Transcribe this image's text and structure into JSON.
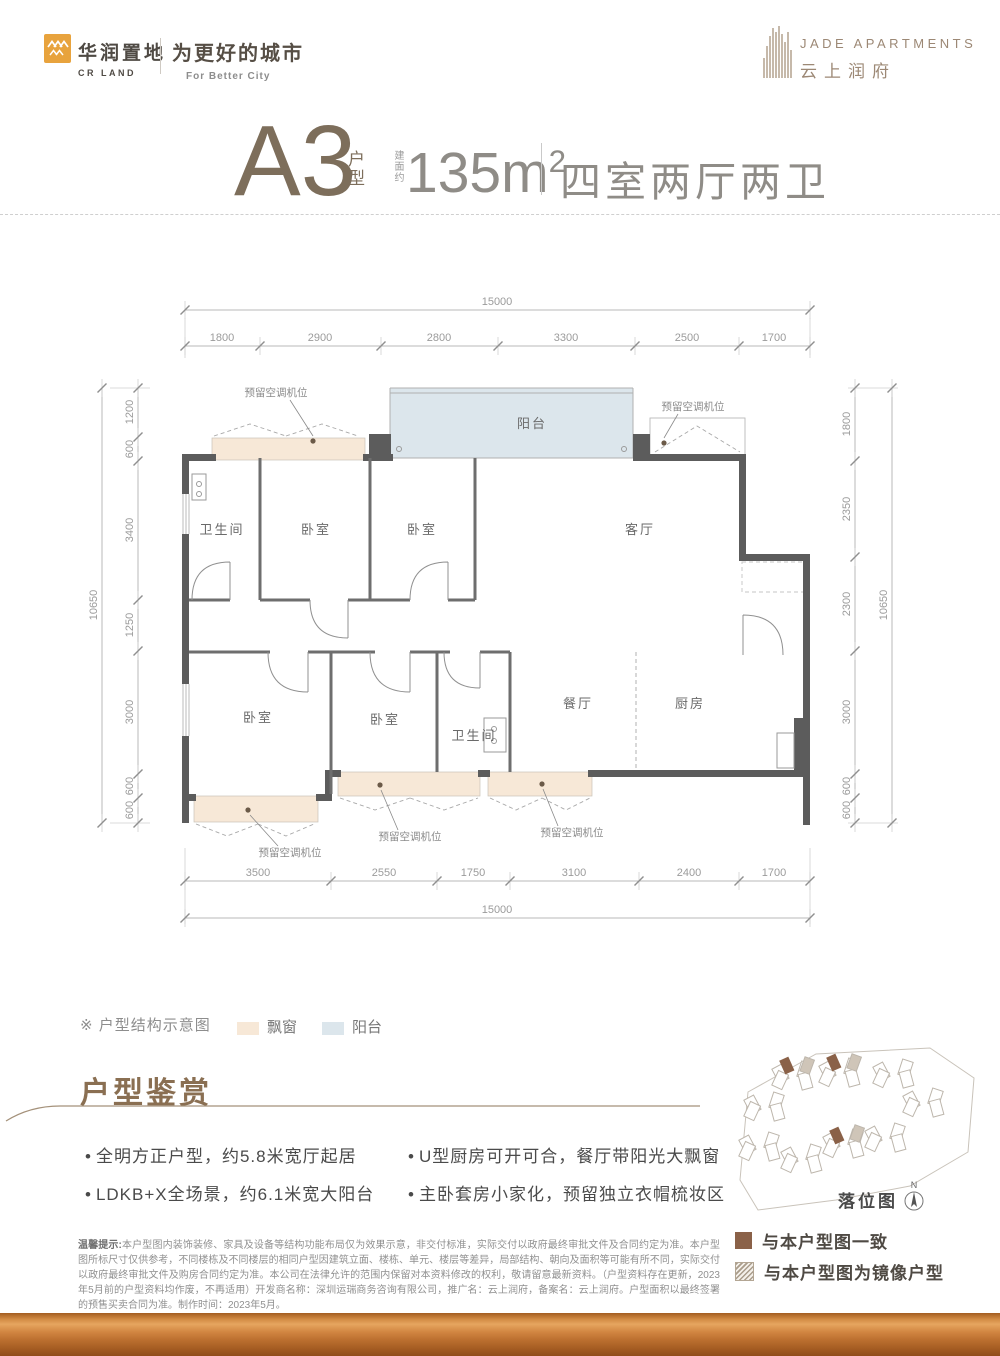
{
  "brand": {
    "cr_cn": "华润置地",
    "cr_en": "CR LAND",
    "slogan_cn": "为更好的城市",
    "slogan_en": "For Better City",
    "project_en": "JADE APARTMENTS",
    "project_cn": "云上润府"
  },
  "title": {
    "unit": "A3",
    "unit_suffix": "户型",
    "area_prefix": "建面约",
    "area": "135m",
    "area_sup": "2",
    "layout": "四室两厅两卫"
  },
  "plan": {
    "rooms": {
      "bath": "卫生间",
      "bed": "卧室",
      "living": "客厅",
      "balcony": "阳台",
      "dining": "餐厅",
      "kitchen": "厨房",
      "ac": "预留空调机位"
    },
    "dims": {
      "total_w": "15000",
      "total_h": "10650",
      "top": [
        "1800",
        "2900",
        "2800",
        "3300",
        "2500",
        "1700"
      ],
      "bottom": [
        "3500",
        "2550",
        "1750",
        "3100",
        "2400",
        "1700"
      ],
      "left": [
        "1200",
        "600",
        "3400",
        "1250",
        "3000",
        "600",
        "600"
      ],
      "right": [
        "1800",
        "2350",
        "2300",
        "3000",
        "600",
        "600"
      ]
    }
  },
  "legend": {
    "note": "※ 户型结构示意图",
    "bay": "飘窗",
    "balcony": "阳台"
  },
  "features": {
    "heading": "户型鉴赏",
    "bullet": "•",
    "col1": [
      "全明方正户型，约5.8米宽厅起居",
      "LDKB+X全场景，约6.1米宽大阳台"
    ],
    "col2": [
      "U型厨房可开可合，餐厅带阳光大飘窗",
      "主卧套房小家化，预留独立衣帽梳妆区"
    ]
  },
  "map": {
    "caption": "落位图",
    "north": "N",
    "legend_same": "与本户型图一致",
    "legend_mirror": "与本户型图为镜像户型"
  },
  "disclaimer": {
    "prefix": "温馨提示:",
    "body": "本户型图内装饰装修、家具及设备等结构功能布局仅为效果示意，非交付标准，实际交付以政府最终审批文件及合同约定为准。本户型图所标尺寸仅供参考，不同楼栋及不同楼层的相同户型因建筑立面、楼栋、单元、楼层等差异，局部结构、朝向及面积等可能有所不同，实际交付以政府最终审批文件及购房合同约定为准。本公司在法律允许的范围内保留对本资料修改的权利，敬请留意最新资料。（户型资料存在更新，2023年5月前的户型资料均作废，不再适用）开发商名称：深圳运瑞商务咨询有限公司，推广名：云上润府，备案名：云上润府。户型面积以最终签署的预售买卖合同为准。制作时间：2023年5月。"
  },
  "colors": {
    "brand_orange": "#E8A33D",
    "bay": "#f7e8d7",
    "balcony": "#dce6ec",
    "wall": "#5c5c5c",
    "brown": "#8a6f52",
    "bar": "#c97a35"
  }
}
